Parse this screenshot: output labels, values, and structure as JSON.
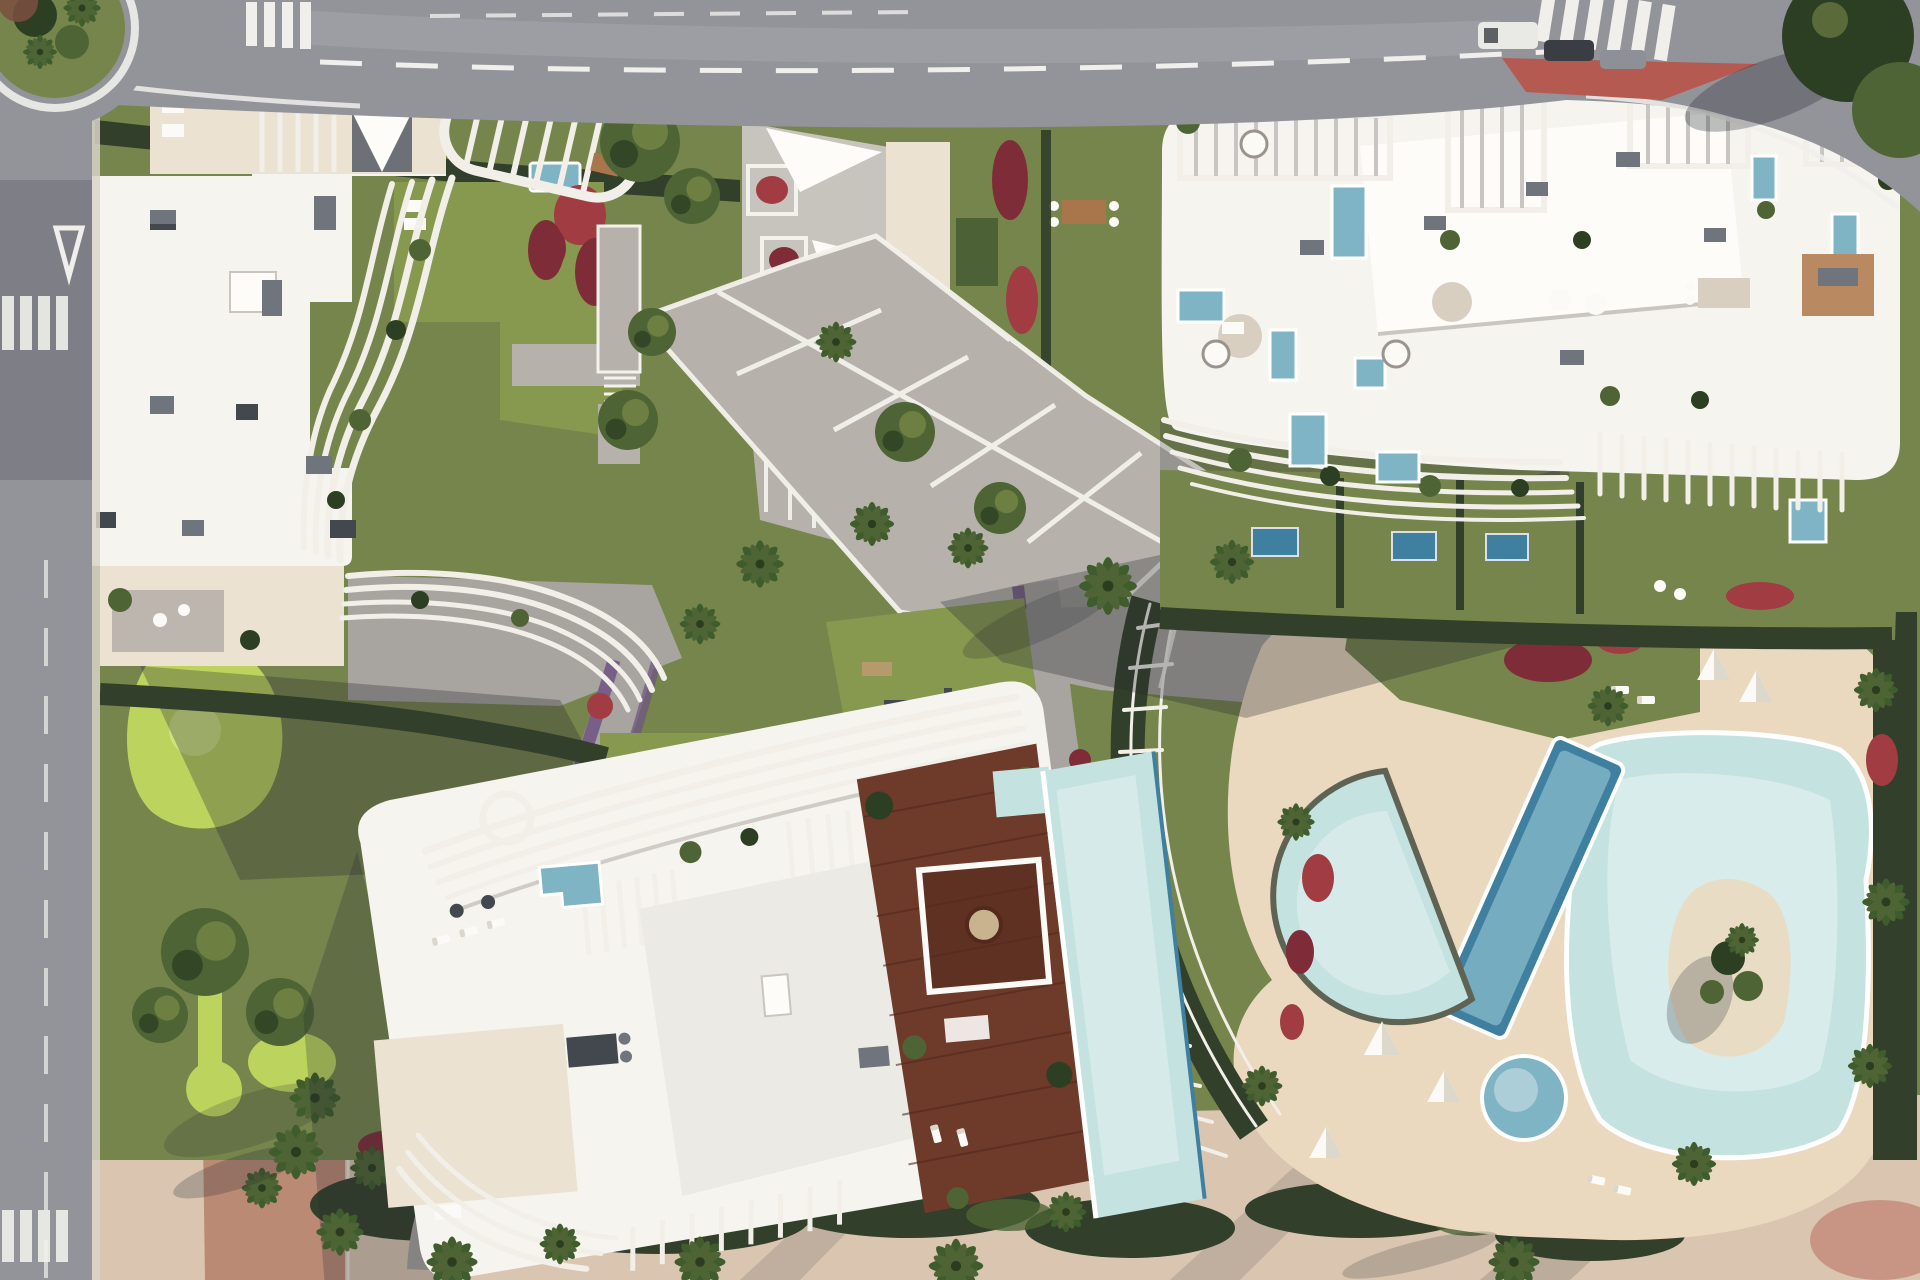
{
  "meta": {
    "kind": "aerial-architectural-render",
    "subject": "Top-down render of a luxury residential complex: three curvilinear white apartment buildings with sculpted balcony fins, rooftop terraces with plunge pools, a central paved plaza, landscaped gardens with red and purple flower beds, palm trees, a mini-golf garden, a large lagoon pool deck with crescent, lap and kids pools, bordered by asphalt streets with crosswalks and a roundabout.",
    "view": "orthographic top-down, sunlight from upper right, shadows cast to lower left"
  },
  "palette": {
    "asphalt": "#93939a",
    "asphalt_dark": "#6e6e76",
    "asphalt_light": "#b3b2b6",
    "road_mark": "#f0efeb",
    "red_island": "#b45a50",
    "bike_path": "#bb8a74",
    "roof_white": "#f6f4ee",
    "roof_bright": "#fdfcf9",
    "terrace_cream": "#ebe2d1",
    "fin_white": "#f1efe8",
    "fin_shadow": "#c8c5c2",
    "vent_gray": "#70747c",
    "vent_dark": "#43474e",
    "plaza_pave": "#b6b2ab",
    "plaza_line": "#f4f2ec",
    "path_gray": "#a8a49f",
    "sand_deck": "#ead9bf",
    "sand_pink": "#d9c5b0",
    "lawn": "#76854c",
    "lawn_bright": "#87984f",
    "golf_green": "#bcd45e",
    "hedge_dark": "#323f2a",
    "tree_mid": "#4e6434",
    "tree_dark": "#2d3f23",
    "palm_green": "#3f5c2d",
    "flower_red": "#a03c42",
    "flower_crimson": "#7e2d38",
    "flower_purple": "#6e5383",
    "pool_pale": "#c4e2e0",
    "pool_mid": "#7fb4c4",
    "pool_deep": "#3f7fa0",
    "island_sand": "#e8ddc4",
    "wood": "#6e3a2a",
    "wood_dark": "#53291d",
    "furniture_white": "#fbfaf6",
    "shadow_color": "#272c33",
    "car_white": "#e9e9e6",
    "car_dark": "#3a3e44"
  },
  "scene": {
    "regions": [
      {
        "name": "top-road",
        "label": "asphalt avenue with dashed lane lines, two zebra crossings, parked cars and a red traffic island"
      },
      {
        "name": "left-road",
        "label": "asphalt street with crosswalks and give-way markings"
      },
      {
        "name": "roundabout",
        "label": "landscaped roundabout with palms at top-left corner"
      },
      {
        "name": "building-a",
        "label": "north-west apartment building with wavy white balcony fins"
      },
      {
        "name": "building-b",
        "label": "north-east apartment building with rooftop terraces, pergolas and plunge pools"
      },
      {
        "name": "building-c",
        "label": "southern building with rooftop wooden deck and infinity pool"
      },
      {
        "name": "central-plaza",
        "label": "gray paved plaza with white grid lines, trees and palms"
      },
      {
        "name": "pool-deck",
        "label": "sand-colored deck with lagoon pool, crescent pool, tilted lap pool, kids pool and island"
      },
      {
        "name": "mini-golf-garden",
        "label": "garden with bright green mini-golf greens and winding paths"
      },
      {
        "name": "gym-lawn",
        "label": "lawn with outdoor exercise equipment"
      },
      {
        "name": "flower-beds",
        "label": "red and purple flowering ground cover along walkways"
      },
      {
        "name": "south-promenade",
        "label": "pink-sand promenade with hedge band and palm trees"
      }
    ]
  }
}
